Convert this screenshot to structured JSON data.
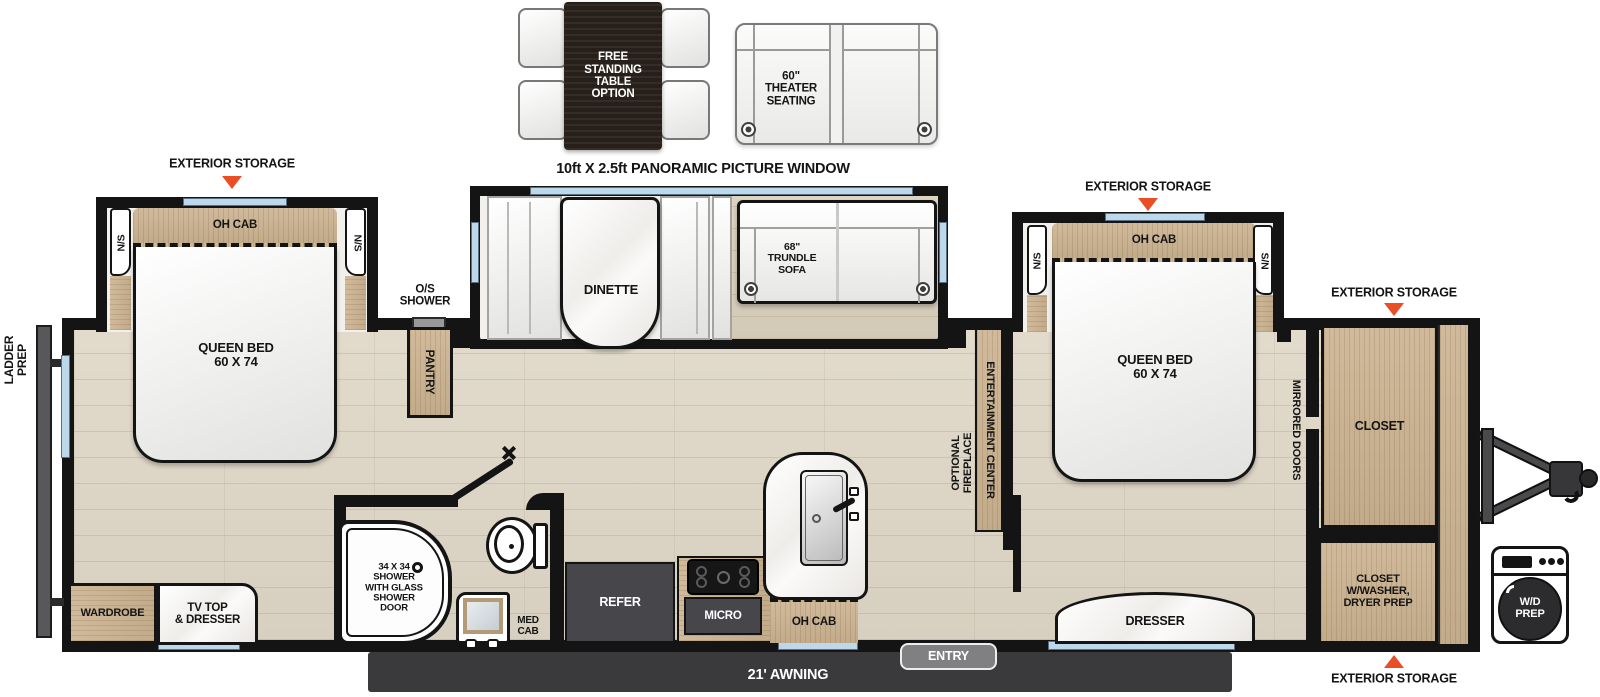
{
  "colors": {
    "accent_triangle": "#E94E24",
    "window_glass": "#BCD8EA",
    "awning_bar": "#3A3A3C"
  },
  "header": {
    "panoramic_window": "10ft X 2.5ft PANORAMIC PICTURE WINDOW"
  },
  "options": {
    "free_standing_table": "FREE\nSTANDING\nTABLE\nOPTION",
    "theater_seating": "60\"\nTHEATER\nSEATING"
  },
  "exterior": {
    "storage": "EXTERIOR STORAGE",
    "awning": "21' AWNING",
    "entry": "ENTRY",
    "ladder_prep": "LADDER\nPREP",
    "wd_prep": "W/D\nPREP"
  },
  "bedroom_rear": {
    "oh_cab": "OH CAB",
    "nightstand_left": "N/S",
    "nightstand_right": "N/S",
    "bed": "QUEEN BED\n60 X 74",
    "wardrobe": "WARDROBE",
    "tv_top_dresser": "TV TOP\n& DRESSER"
  },
  "living": {
    "dinette": "DINETTE",
    "trundle_sofa": "68\"\nTRUNDLE\nSOFA",
    "pantry": "PANTRY",
    "os_shower": "O/S\nSHOWER",
    "entertainment_center": "ENTERTAINMENT CENTER",
    "optional_fireplace": "OPTIONAL\nFIREPLACE"
  },
  "bathroom": {
    "shower": "34 X 34\nSHOWER\nWITH GLASS\nSHOWER\nDOOR",
    "med_cab": "MED\nCAB"
  },
  "kitchen": {
    "refer": "REFER",
    "micro": "MICRO",
    "oh_cab": "OH CAB"
  },
  "bedroom_front": {
    "oh_cab": "OH CAB",
    "nightstand_left": "N/S",
    "nightstand_right": "S/N",
    "bed": "QUEEN BED\n60 X 74",
    "dresser": "DRESSER",
    "mirrored_doors": "MIRRORED DOORS",
    "closet": "CLOSET",
    "closet_washer": "CLOSET\nW/WASHER,\nDRYER PREP"
  }
}
